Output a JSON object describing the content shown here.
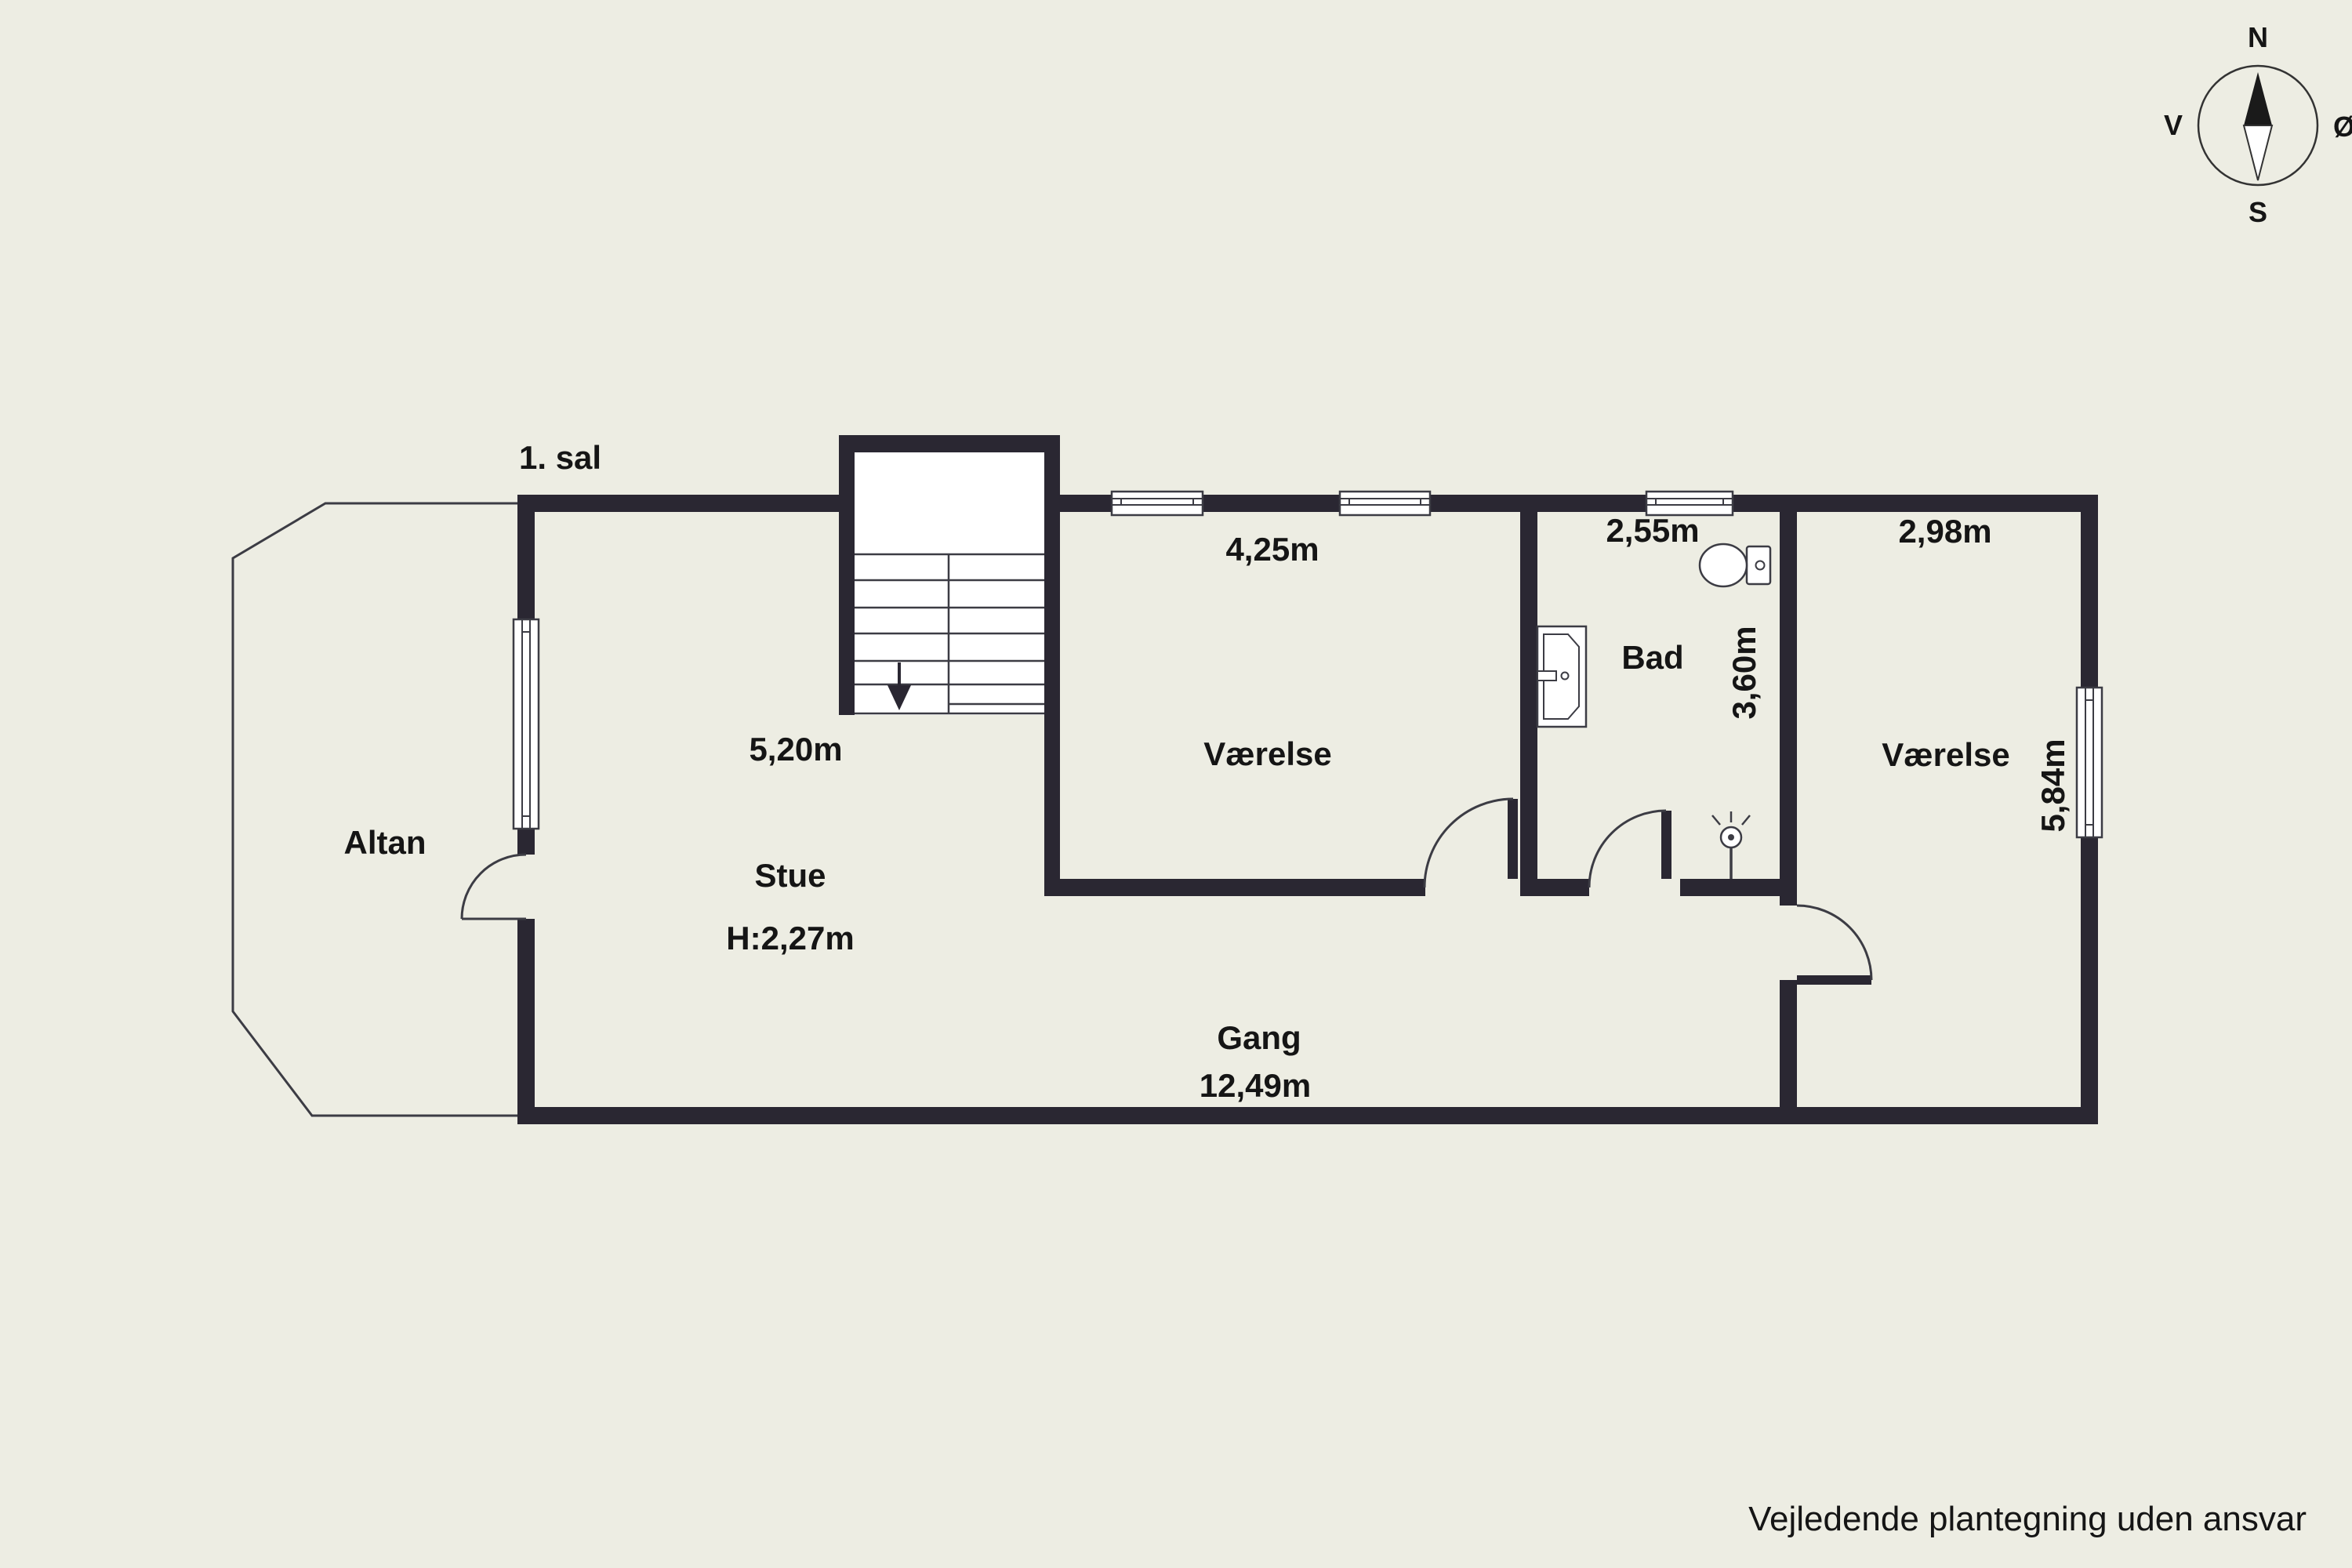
{
  "page": {
    "background_color": "#EDEDE3",
    "wall_color": "#2A2732",
    "thin_line_color": "#3C3C44",
    "text_color": "#151515",
    "fixture_fill_color": "#FFFFFF"
  },
  "title": "1. sal",
  "floor_plan": {
    "rooms": [
      {
        "id": "altan",
        "label": "Altan"
      },
      {
        "id": "stue",
        "label": "Stue",
        "ceiling_height": "H:2,27m",
        "width": "5,20m"
      },
      {
        "id": "vaerelse_center",
        "label": "Værelse",
        "width": "4,25m"
      },
      {
        "id": "bad",
        "label": "Bad",
        "width": "2,55m",
        "depth": "3,60m"
      },
      {
        "id": "vaerelse_right",
        "label": "Værelse",
        "width": "2,98m",
        "depth": "5,84m"
      },
      {
        "id": "gang",
        "label": "Gang",
        "length": "12,49m"
      }
    ],
    "fixtures": [
      {
        "id": "stairs",
        "name": "staircase with down arrow"
      },
      {
        "id": "toilet",
        "name": "toilet"
      },
      {
        "id": "sink",
        "name": "bathroom sink"
      },
      {
        "id": "ceiling_light",
        "name": "ceiling light"
      }
    ],
    "window_count": 5,
    "door_count": 4
  },
  "compass": {
    "north": "N",
    "south": "S",
    "west": "V",
    "east": "Ø"
  },
  "disclaimer": "Vejledende plantegning uden ansvar"
}
